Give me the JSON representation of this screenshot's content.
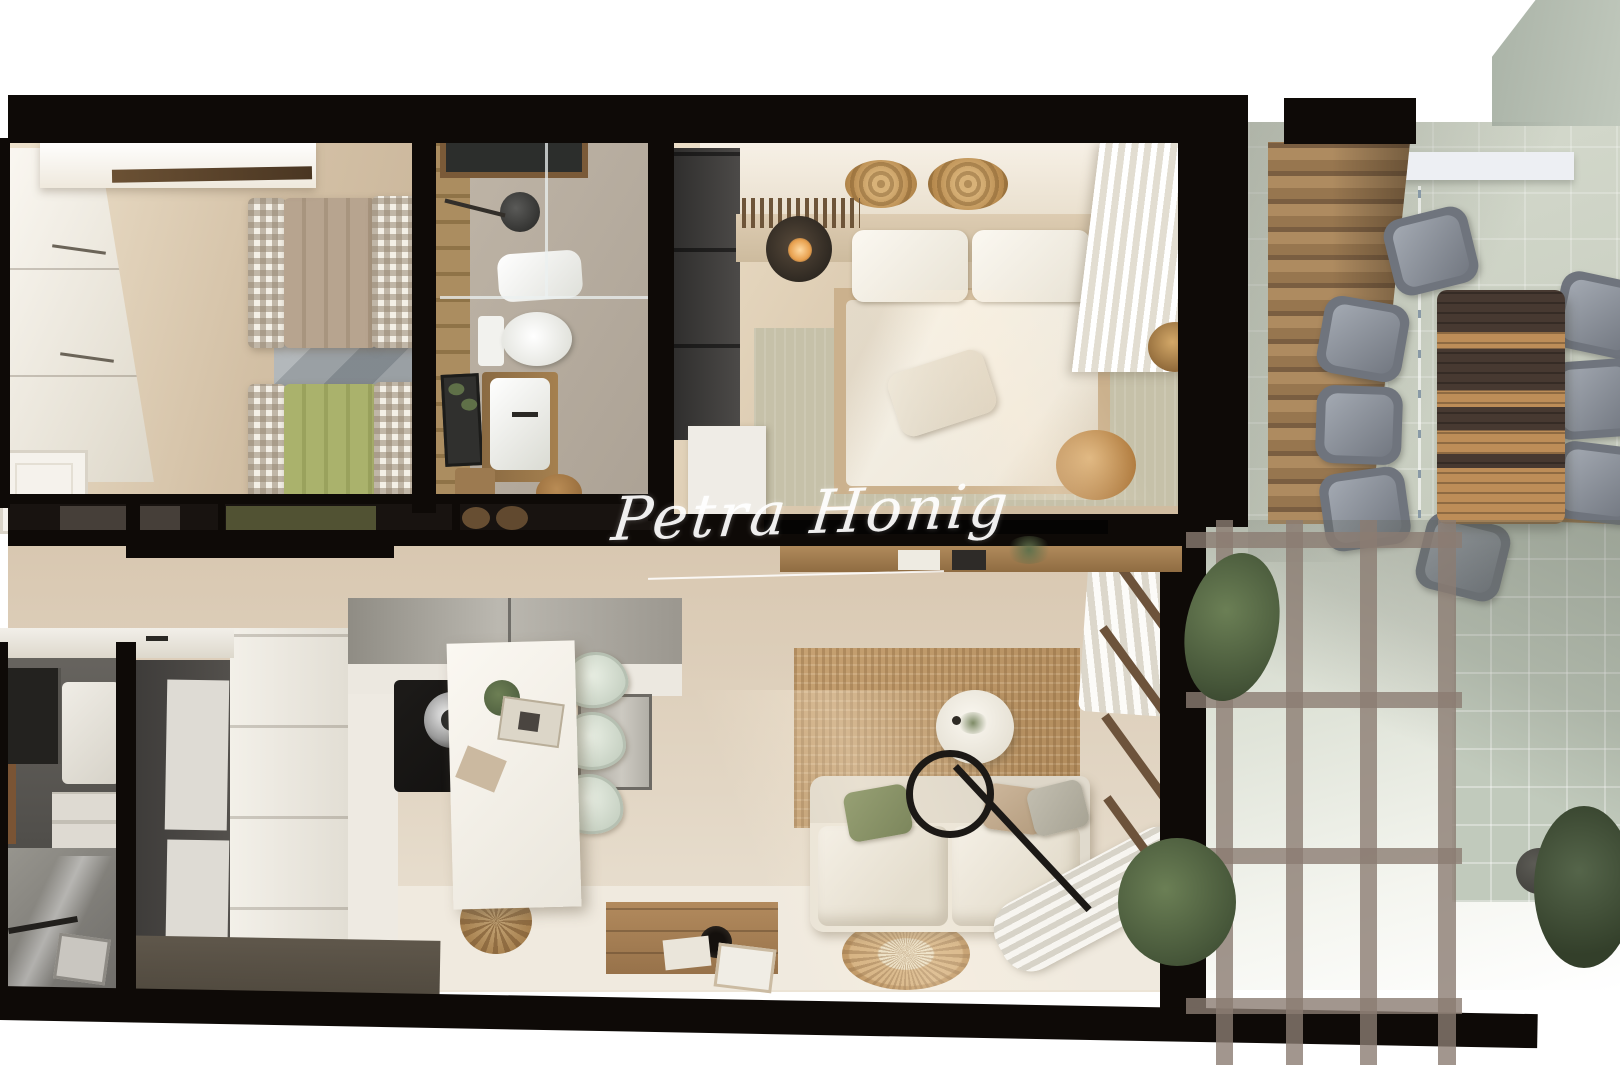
{
  "watermark": {
    "text": "Petra Honig"
  },
  "palette": {
    "wall": "#0e0a07",
    "floor_beige": "#d7c5ad",
    "floor_light": "#efe9df",
    "terrace_tile": "#c9cfc1",
    "terrace_wall": "#c1cabc",
    "pergola": "#8b7c72",
    "wood": "#9c7a50",
    "stairs_wood": "#97764f",
    "jute": "#bc9a6c",
    "sofa_cream": "#ece6da",
    "green_pillow": "#8b9468",
    "green_bed": "#a4ac62",
    "taupe_bed": "#b3a08c",
    "table_dark": "#473931",
    "table_tan": "#bd8d58",
    "chair_gray": "#8a8f98",
    "cabinet_dark": "#474543",
    "cooktop_black": "#161412",
    "sage_rug": "#c6c1a9",
    "building_gray": "#b4bdb1"
  }
}
